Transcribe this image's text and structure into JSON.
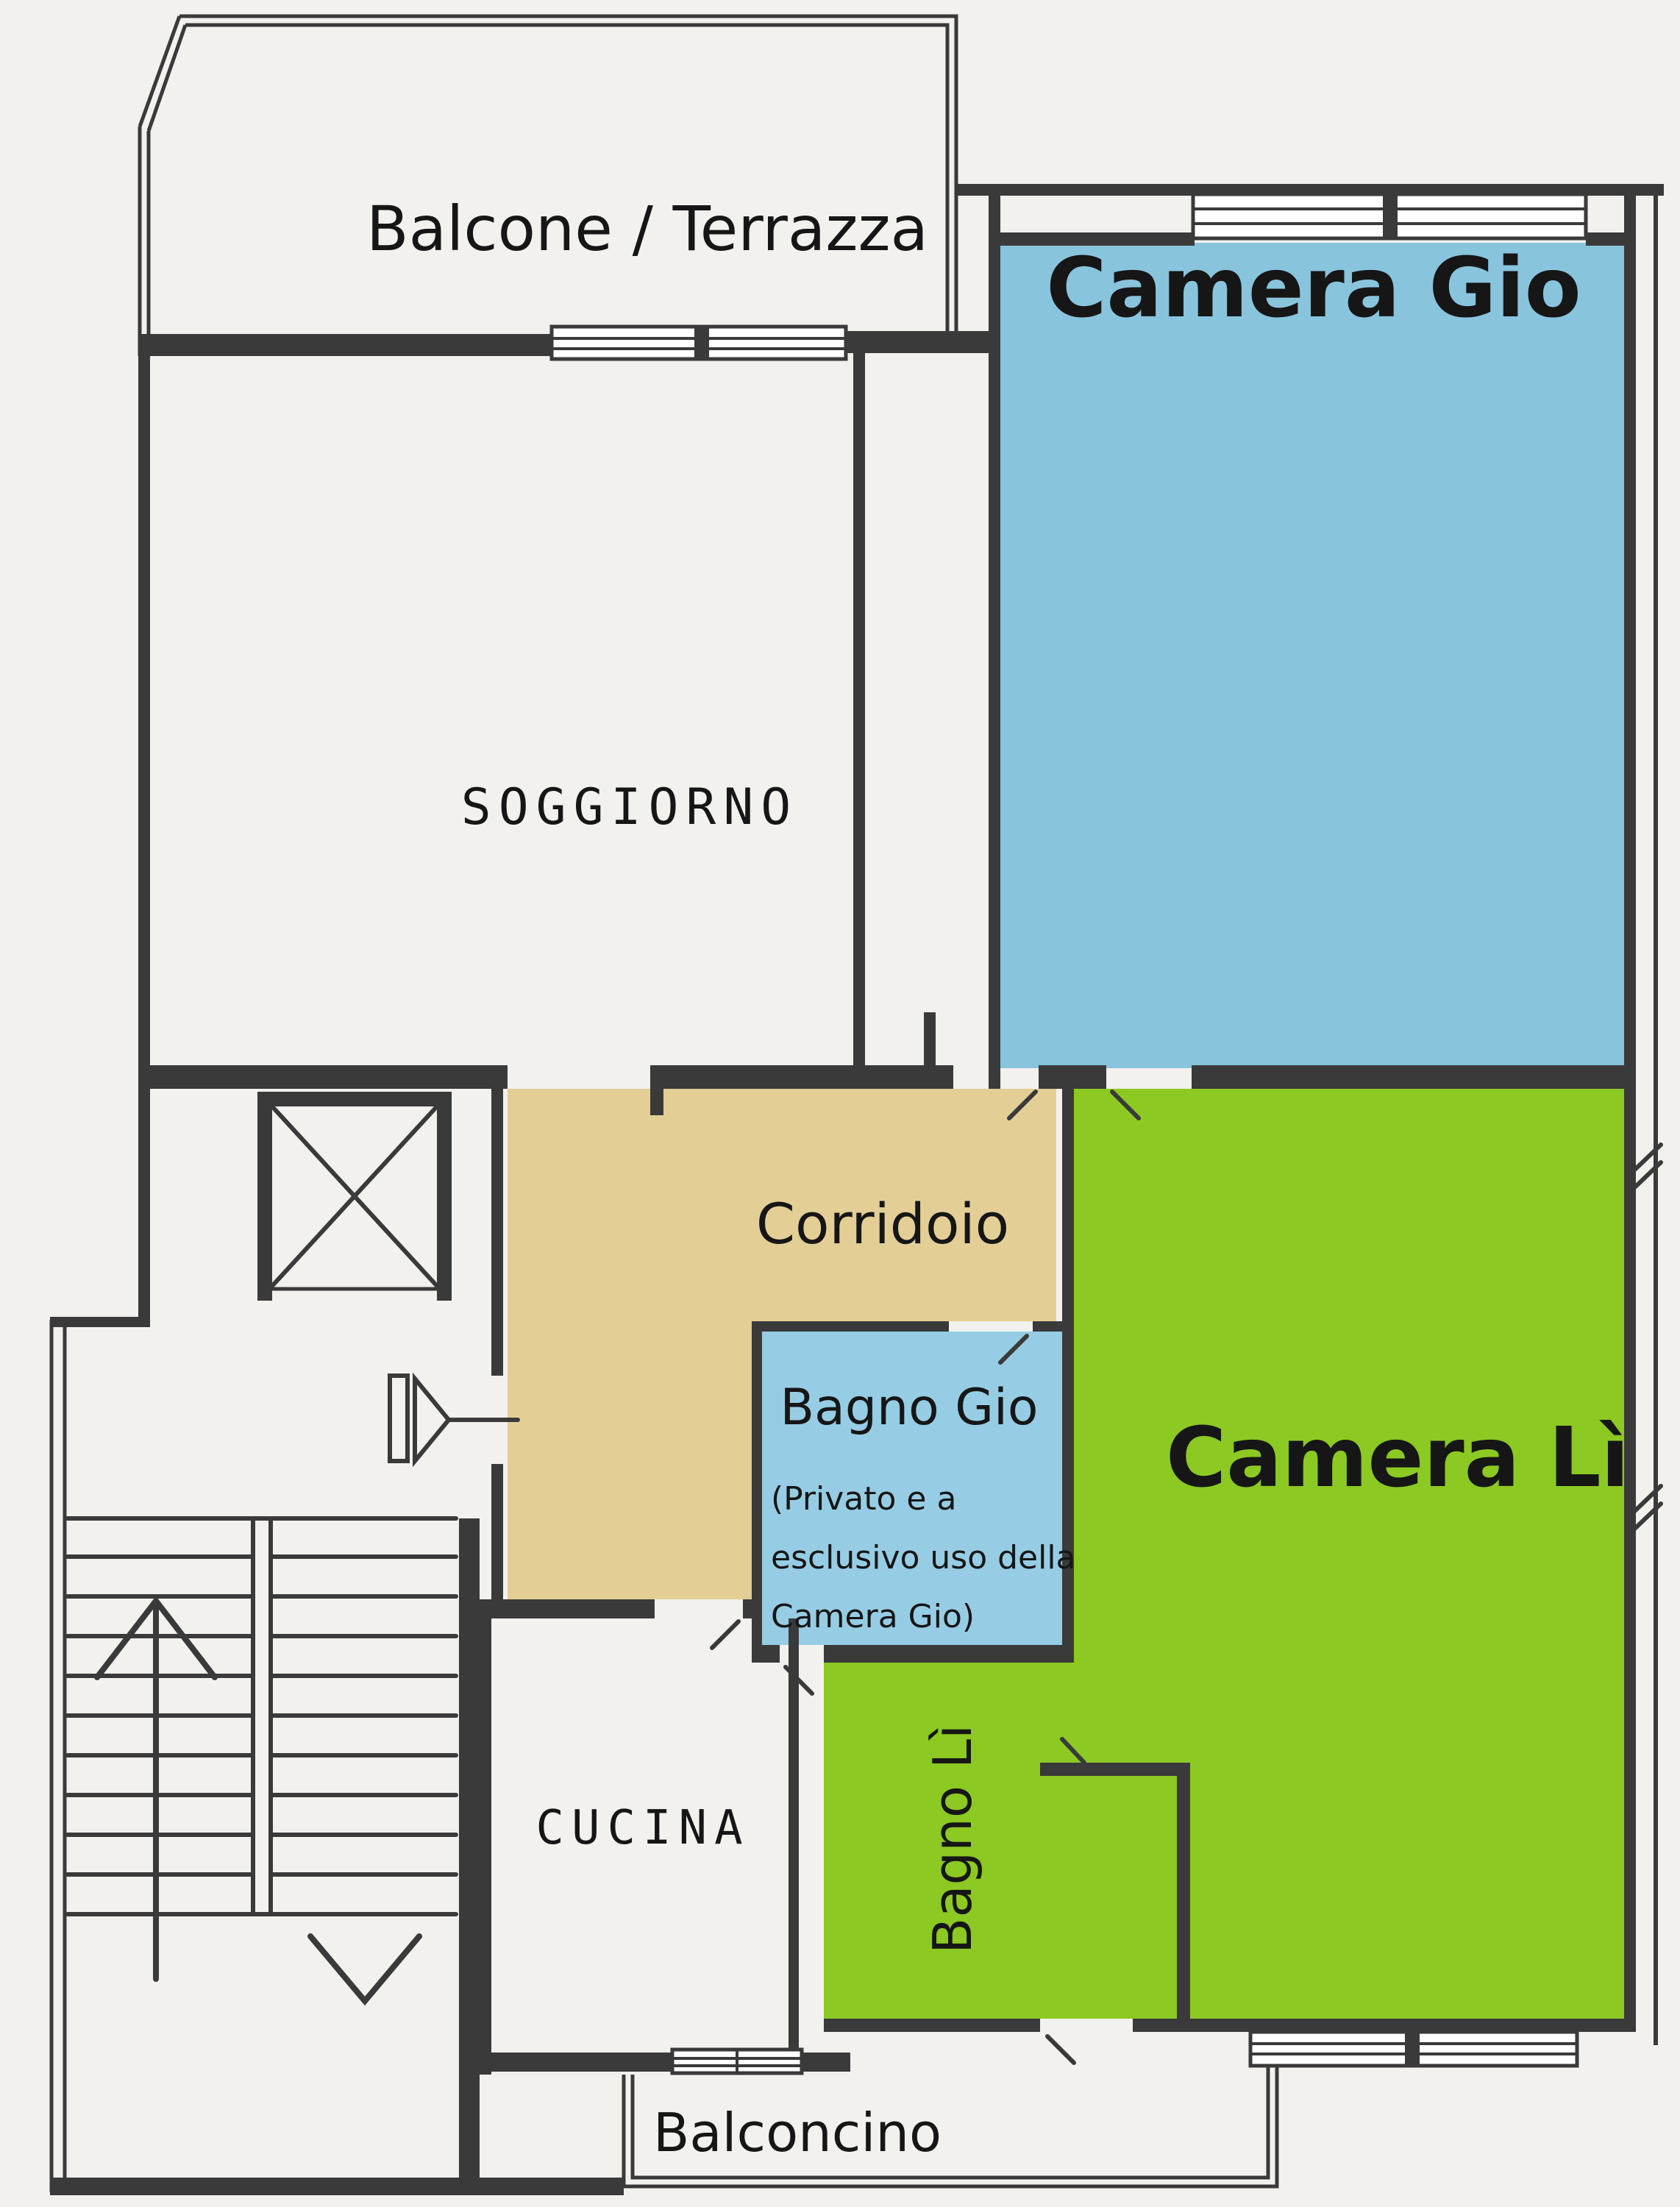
{
  "plan": {
    "type": "apartment-floor-plan",
    "language": "Italian"
  },
  "colors": {
    "paper": "#f2f1ee",
    "walls": "#3a3a3a",
    "text": "#161616",
    "camera_gio_fill": "#89c4dd",
    "bagno_gio_fill": "#96cde4",
    "camera_li_fill": "#8cc922",
    "bagno_li_fill": "#8cc922",
    "corridoio_fill": "#e3cf96"
  },
  "rooms": {
    "balcone": {
      "label": "Balcone / Terrazza"
    },
    "soggiorno": {
      "label": "SOGGIORNO"
    },
    "camera_gio": {
      "label": "Camera Gio",
      "fill": "#89c4dd"
    },
    "corridoio": {
      "label": "Corridoio",
      "fill": "#e3cf96"
    },
    "bagno_gio": {
      "label": "Bagno Gio",
      "fill": "#96cde4",
      "note_line1": "(Privato e a",
      "note_line2": "esclusivo uso della",
      "note_line3": "Camera Gio)"
    },
    "camera_li": {
      "label": "Camera Lì",
      "fill": "#8cc922"
    },
    "bagno_li": {
      "label": "Bagno Lì",
      "fill": "#8cc922"
    },
    "cucina": {
      "label": "CUCINA"
    },
    "balconcino": {
      "label": "Balconcino"
    }
  },
  "symbols": {
    "elevator": "crossed-box elevator shaft",
    "stairs_up_arrow": "chevron-up with stem",
    "stairs_down_arrow": "chevron-down",
    "entry_door": "jamb bar + right-pointing triangle",
    "door_tick": "diagonal swing tick",
    "window": "double-line window band"
  }
}
